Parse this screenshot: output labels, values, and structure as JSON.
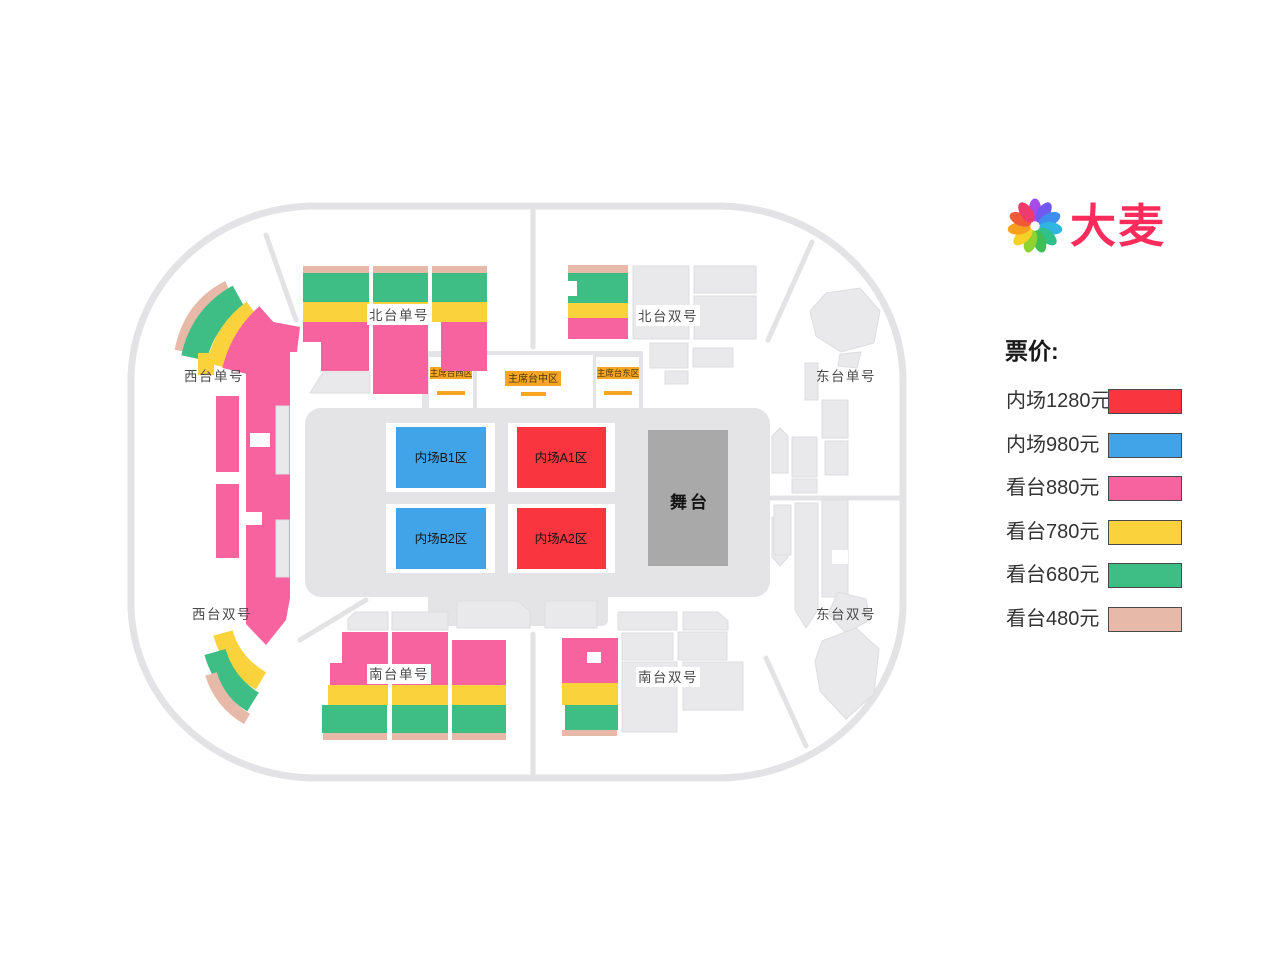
{
  "logo": {
    "brand": "大麦",
    "brand_color": "#FB2C5C",
    "petals": [
      "#A44BE8",
      "#7158EE",
      "#3E8EF0",
      "#2EB6E0",
      "#30C08A",
      "#3FBE55",
      "#8FD333",
      "#F7D028",
      "#F7A01E",
      "#F05A36",
      "#EF3A6E"
    ]
  },
  "legend": {
    "title": "票价:",
    "items": [
      {
        "label": "内场1280元"
      },
      {
        "label": "内场980元"
      },
      {
        "label": "看台880元"
      },
      {
        "label": "看台780元"
      },
      {
        "label": "看台680元"
      },
      {
        "label": "看台480元"
      }
    ]
  },
  "colors": {
    "red": "#F93640",
    "blue": "#41A4E8",
    "pink": "#F7639E",
    "yellow": "#FAD23C",
    "green": "#3EBE85",
    "tan": "#E7B9A8",
    "accent_orange": "#F6A623"
  },
  "map": {
    "stands": {
      "north_odd": "北台单号",
      "north_even": "北台双号",
      "west_odd": "西台单号",
      "west_even": "西台双号",
      "east_odd": "东台单号",
      "east_even": "东台双号",
      "south_odd": "南台单号",
      "south_even": "南台双号"
    },
    "podium": {
      "west": "主席台西区",
      "center": "主席台中区",
      "east": "主席台东区"
    },
    "floor": {
      "b1": "内场B1区",
      "a1": "内场A1区",
      "b2": "内场B2区",
      "a2": "内场A2区",
      "stage": "舞台"
    }
  }
}
